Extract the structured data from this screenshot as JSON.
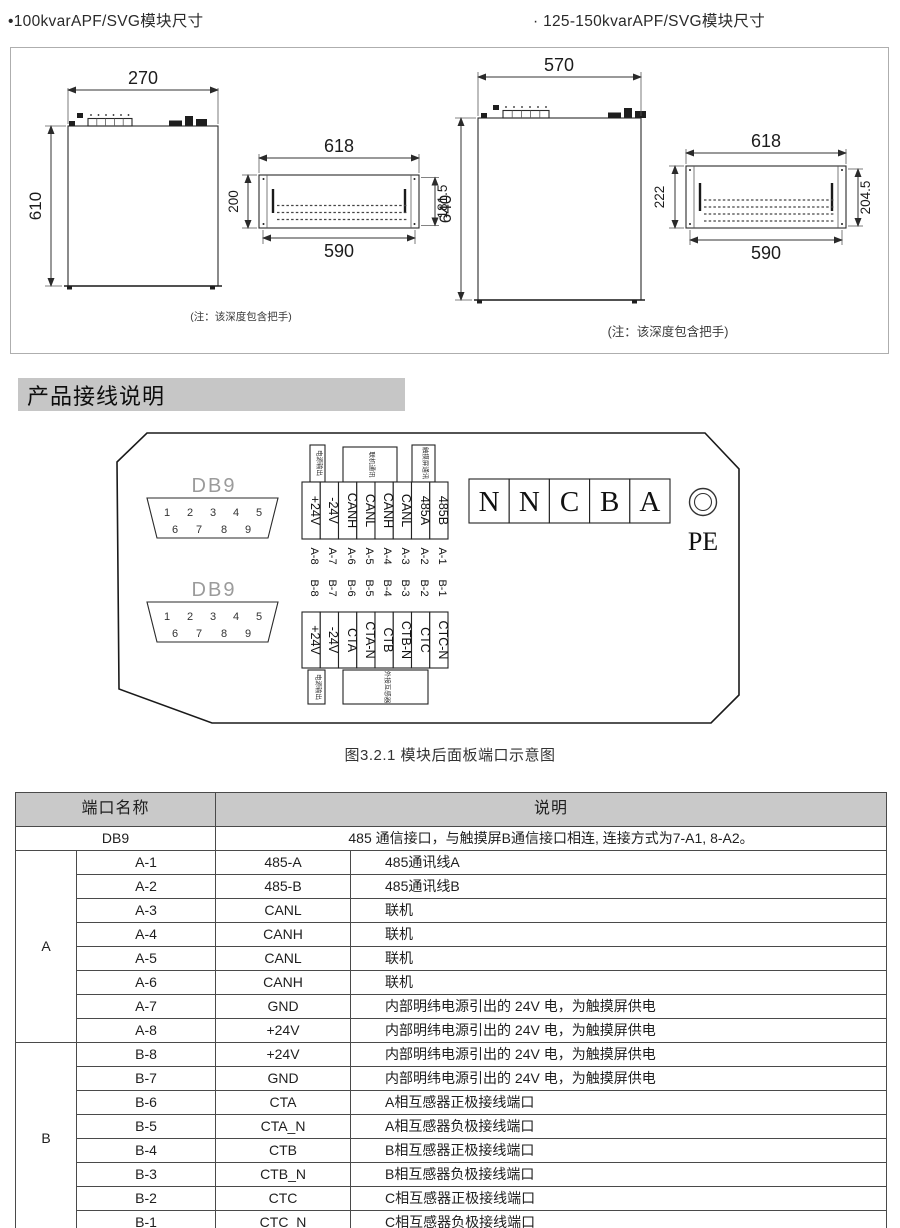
{
  "titles": {
    "left": "•100kvarAPF/SVG模块尺寸",
    "right": "· 125-150kvarAPF/SVG模块尺寸"
  },
  "dims": {
    "left_front": {
      "w": "270",
      "h": "610"
    },
    "left_rear": {
      "top": "618",
      "left": "200",
      "right": "181.5",
      "bottom": "590"
    },
    "right_front": {
      "w": "570",
      "h": "640"
    },
    "right_rear": {
      "top": "618",
      "left": "222",
      "right": "204.5",
      "bottom": "590"
    }
  },
  "notes": {
    "left": "(注：该深度包含把手)",
    "right": "(注：该深度包含把手)"
  },
  "wiring": {
    "header": "产品接线说明",
    "caption": "图3.2.1 模块后面板端口示意图"
  },
  "diagram": {
    "db9_label": "DB9",
    "db9_pins_row1": [
      "1",
      "2",
      "3",
      "4",
      "5"
    ],
    "db9_pins_row2": [
      "6",
      "7",
      "8",
      "9"
    ],
    "strip_a": {
      "function_labels": [
        "电源输出",
        "联机通讯",
        "触摸屏通讯"
      ],
      "terminals": [
        "+24V",
        "-24V",
        "CANH",
        "CANL",
        "CANH",
        "CANL",
        "485A",
        "485B"
      ],
      "pins": [
        "A-8",
        "A-7",
        "A-6",
        "A-5",
        "A-4",
        "A-3",
        "A-2",
        "A-1"
      ]
    },
    "strip_b": {
      "pins": [
        "B-8",
        "B-7",
        "B-6",
        "B-5",
        "B-4",
        "B-3",
        "B-2",
        "B-1"
      ],
      "terminals": [
        "+24V",
        "-24V",
        "CTA",
        "CTA-N",
        "CTB",
        "CTB-N",
        "CTC",
        "CTC-N"
      ],
      "function_labels": [
        "电源输出",
        "外接互感器"
      ]
    },
    "bus_terminals": [
      "N",
      "N",
      "C",
      "B",
      "A"
    ],
    "pe_label": "PE"
  },
  "table": {
    "header": [
      "端口名称",
      "说明"
    ],
    "db9_row": {
      "name": "DB9",
      "desc": "485 通信接口，与触摸屏B通信接口相连, 连接方式为7-A1, 8-A2。"
    },
    "groups": [
      {
        "name": "A",
        "rows": [
          [
            "A-1",
            "485-A",
            "485通讯线A"
          ],
          [
            "A-2",
            "485-B",
            "485通讯线B"
          ],
          [
            "A-3",
            "CANL",
            "联机"
          ],
          [
            "A-4",
            "CANH",
            "联机"
          ],
          [
            "A-5",
            "CANL",
            "联机"
          ],
          [
            "A-6",
            "CANH",
            "联机"
          ],
          [
            "A-7",
            "GND",
            "内部明纬电源引出的 24V 电，为触摸屏供电"
          ],
          [
            "A-8",
            "+24V",
            "内部明纬电源引出的 24V 电，为触摸屏供电"
          ]
        ]
      },
      {
        "name": "B",
        "rows": [
          [
            "B-8",
            "+24V",
            "内部明纬电源引出的 24V 电，为触摸屏供电"
          ],
          [
            "B-7",
            "GND",
            "内部明纬电源引出的 24V 电，为触摸屏供电"
          ],
          [
            "B-6",
            "CTA",
            "A相互感器正极接线端口"
          ],
          [
            "B-5",
            "CTA_N",
            "A相互感器负极接线端口"
          ],
          [
            "B-4",
            "CTB",
            "B相互感器正极接线端口"
          ],
          [
            "B-3",
            "CTB_N",
            "B相互感器负极接线端口"
          ],
          [
            "B-2",
            "CTC",
            "C相互感器正极接线端口"
          ],
          [
            "B-1",
            "CTC_N",
            "C相互感器负极接线端口"
          ]
        ]
      }
    ]
  },
  "colors": {
    "section_bar_bg": "#c6c6c6",
    "table_header_bg": "#c9c9c9",
    "db9_label_gray": "#9b9b9b",
    "line_color": "#2a2a2a"
  }
}
